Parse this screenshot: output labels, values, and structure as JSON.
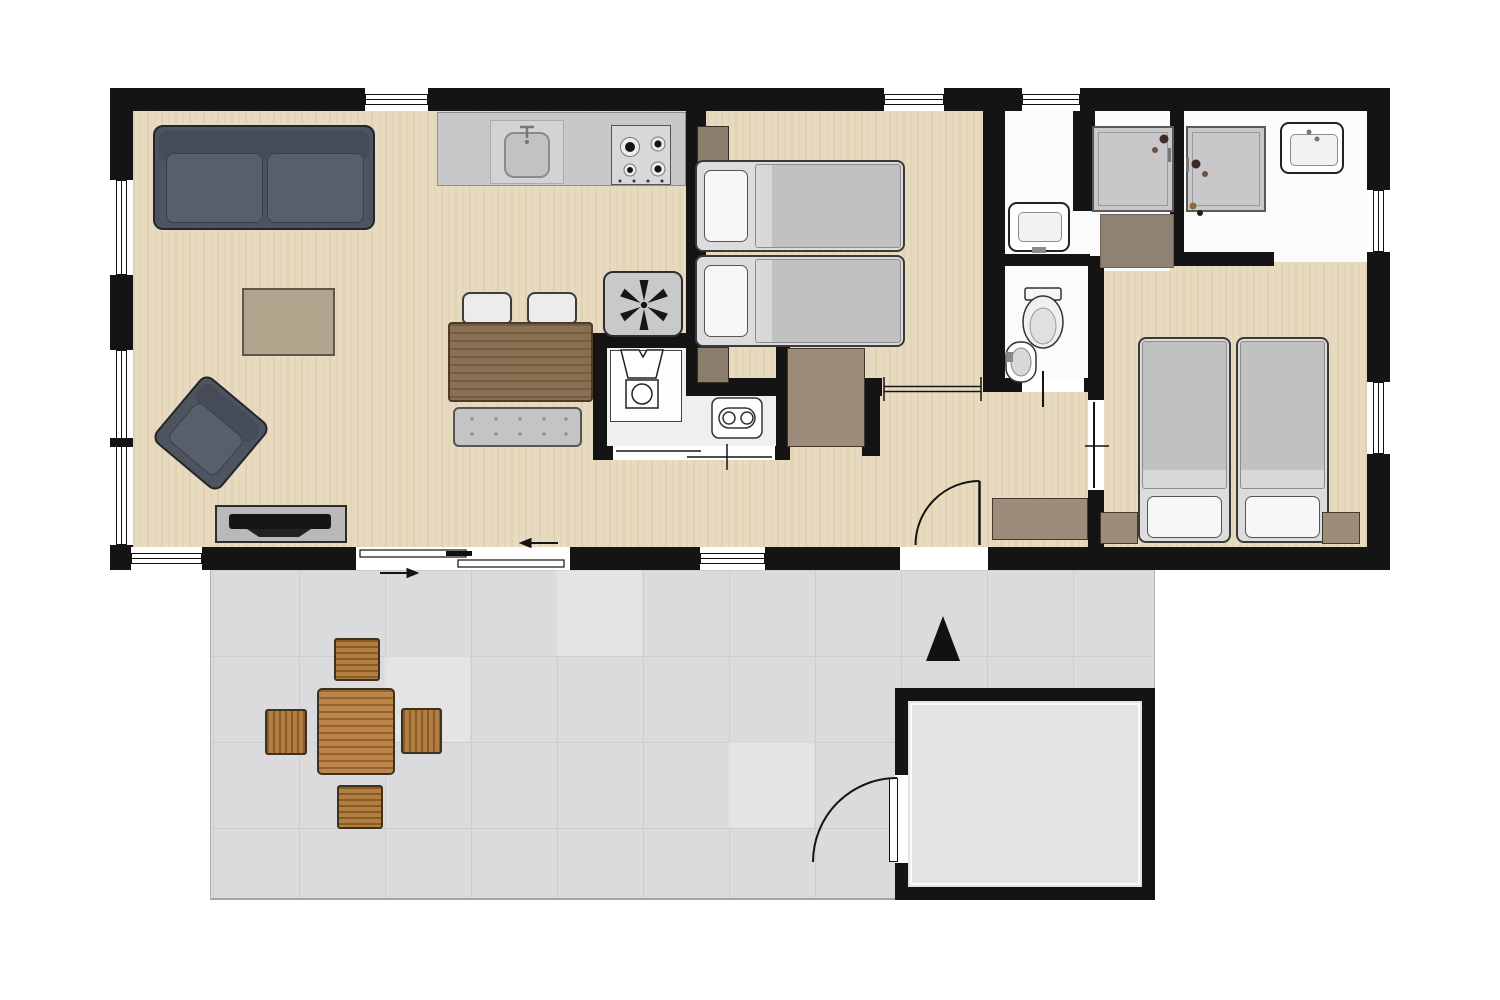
{
  "figure": {
    "type": "floor-plan",
    "description_name": "holiday-lodge-floor-plan-top-view",
    "visible_text_labels": [],
    "entrance_arrow_direction": "up"
  },
  "palette": {
    "wall": "#141414",
    "wood": "#e8dabf",
    "bath": "#fbfbfb",
    "terrace": "#dbdbdd",
    "shed_floor": "#e3e3e5",
    "sofa": "#4d5460",
    "rug": "#b2a58d",
    "counter": "#c8c8c8",
    "table": "#8a7053",
    "bench": "#c4c4c4",
    "bed_blanket": "#c1c1c1",
    "pillow": "#f7f7f7",
    "tray": "#c8c8ca",
    "brown": "#9c8c79",
    "outdoor_wood": "#bc8449",
    "tv": "#161616",
    "line": "#141414"
  },
  "rooms": [
    {
      "name": "living-room",
      "furniture": [
        "sofa",
        "armchair",
        "rug",
        "tv-cabinet",
        "dining-table",
        "dining-chair",
        "dining-chair",
        "dining-bench",
        "heater-fan-unit"
      ]
    },
    {
      "name": "kitchen",
      "furniture": [
        "kitchen-counter",
        "kitchen-sink",
        "stove-4-burners"
      ]
    },
    {
      "name": "utility-closet",
      "furniture": [
        "washing-machine",
        "boiler"
      ]
    },
    {
      "name": "bedroom-1",
      "furniture": [
        "single-bed",
        "single-bed",
        "nightstand",
        "nightstand"
      ]
    },
    {
      "name": "washroom",
      "furniture": [
        "washbasin"
      ]
    },
    {
      "name": "toilet-room",
      "furniture": [
        "toilet",
        "hand-basin"
      ]
    },
    {
      "name": "shower-room",
      "furniture": [
        "shower-tray",
        "shower-mat-cabinet"
      ]
    },
    {
      "name": "bathroom-2",
      "furniture": [
        "shower-tray",
        "washbasin"
      ]
    },
    {
      "name": "bedroom-2",
      "furniture": [
        "single-bed",
        "single-bed",
        "nightstand",
        "nightstand"
      ]
    },
    {
      "name": "hallway",
      "furniture": [
        "wardrobe",
        "entry-cabinet"
      ]
    },
    {
      "name": "terrace",
      "furniture": [
        "outdoor-table",
        "outdoor-chair",
        "outdoor-chair",
        "outdoor-chair",
        "outdoor-chair"
      ]
    },
    {
      "name": "shed",
      "furniture": []
    }
  ],
  "openings": {
    "windows_top_wall": 3,
    "windows_left_wall": 2,
    "windows_right_wall": 2,
    "windows_bottom_wall": 2,
    "sliding_patio_door": 1,
    "entry_door": 1,
    "shed_door": 1,
    "interior_sliding_doors": 3,
    "interior_hinged_doors": 2
  },
  "icons": [
    "fan-icon",
    "laundry-icon",
    "boiler-icon",
    "toilet-icon",
    "burner-icon",
    "faucet-icon",
    "shower-fixture-icon",
    "entrance-arrow-icon",
    "slide-direction-arrow-icon",
    "door-swing-arc-icon"
  ]
}
